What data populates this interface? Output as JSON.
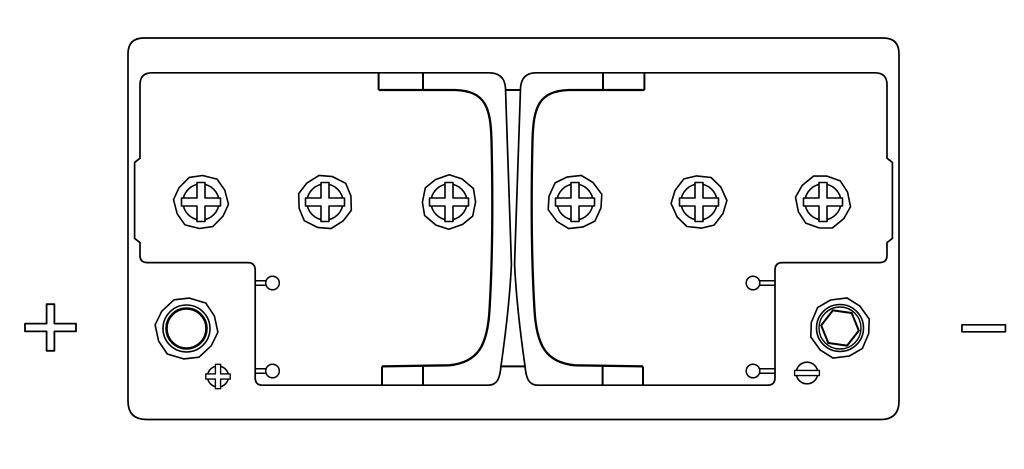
{
  "diagram": {
    "kind": "battery-top-view-technical-drawing",
    "background_color": "#ffffff",
    "line_color": "#000000",
    "case": {
      "x": 128,
      "y": 38,
      "width": 771,
      "height": 381.5,
      "corner_radius": 16
    },
    "polarity_symbols": {
      "positive": {
        "label": "+",
        "side": "left",
        "cx": 50.5,
        "cy": 327.5,
        "arm_h": 25.5,
        "arm_v": 23.3,
        "bar_half_thickness": 3.9
      },
      "negative": {
        "label": "-",
        "side": "right",
        "cx": 983.7,
        "cy": 328.3,
        "width": 43.5,
        "height": 7
      }
    },
    "vent_caps": {
      "count": 6,
      "centers_x": [
        201,
        325,
        449,
        575,
        699,
        823
      ],
      "center_y": 202,
      "outer_radius": 27,
      "inner_radius": 18,
      "cross_half_len": 19.5,
      "cross_half_width": 4
    },
    "terminals": {
      "positive": {
        "cx": 186.5,
        "cy": 328.5,
        "outer_radius": 31,
        "ring_radius": 23.5,
        "bore_radius": 20,
        "marker": {
          "type": "cross",
          "cx": 218,
          "cy": 376.5,
          "radius": 10.5,
          "slot_half_len": 12.2,
          "slot_half_width": 2.6
        }
      },
      "negative": {
        "cx": 840,
        "cy": 328,
        "outer_radius": 30,
        "ring_radius": 23.5,
        "inner_ring_radius": 21,
        "hex_radius": 19,
        "hex_rotation_deg": 8,
        "marker": {
          "type": "slot",
          "cx": 807,
          "cy": 373,
          "radius": 10.8,
          "slot_half_len": 12.4,
          "slot_half_width": 2.6
        }
      }
    },
    "pins": [
      {
        "x": 272.5,
        "y": 283,
        "side": "left"
      },
      {
        "x": 272.5,
        "y": 371,
        "side": "left"
      },
      {
        "x": 753,
        "y": 283,
        "side": "right"
      },
      {
        "x": 753,
        "y": 371,
        "side": "right"
      }
    ],
    "pin_radius": 6.8,
    "pin_stem_half_gap": 2.2,
    "pin_edge_x": {
      "left": 255.2,
      "right": 775
    }
  }
}
